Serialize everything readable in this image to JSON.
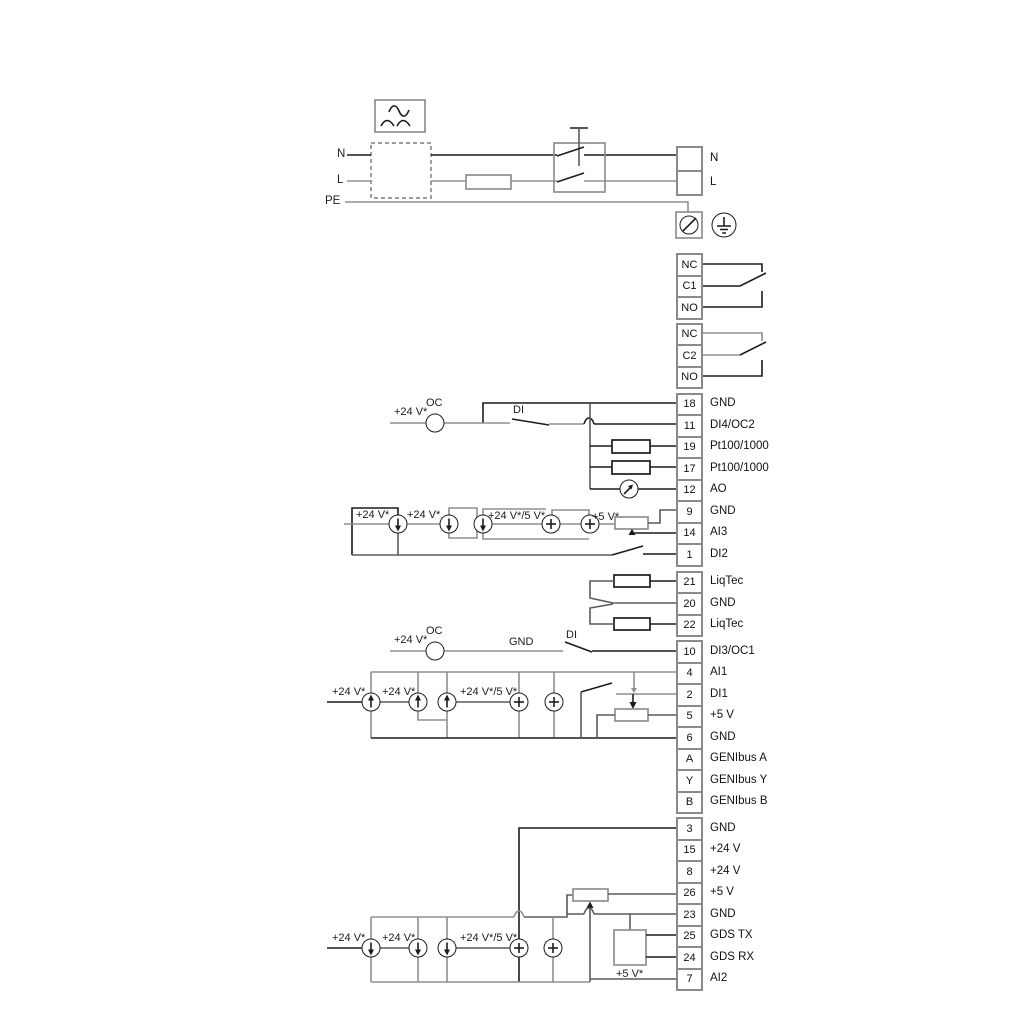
{
  "diagram_title": "pump wiring / terminal connection diagram",
  "colors": {
    "wire_dark": "#1c1c1c",
    "wire_gray": "#8f8f8f",
    "wire_mid": "#5a5a5a",
    "terminal_border": "#8a8a8a",
    "background": "#ffffff"
  },
  "power_labels_left": [
    {
      "text": "N",
      "x": 337,
      "y": 149
    },
    {
      "text": "L",
      "x": 337,
      "y": 175
    },
    {
      "text": "PE",
      "x": 325,
      "y": 196
    }
  ],
  "terminals": {
    "power": [
      {
        "num": "",
        "label": "N"
      },
      {
        "num": "",
        "label": "L"
      }
    ],
    "relay1": [
      {
        "num": "NC",
        "label": ""
      },
      {
        "num": "C1",
        "label": ""
      },
      {
        "num": "NO",
        "label": ""
      }
    ],
    "relay2": [
      {
        "num": "NC",
        "label": ""
      },
      {
        "num": "C2",
        "label": ""
      },
      {
        "num": "NO",
        "label": ""
      }
    ],
    "io1": [
      {
        "num": "18",
        "label": "GND"
      },
      {
        "num": "11",
        "label": "DI4/OC2"
      },
      {
        "num": "19",
        "label": "Pt100/1000"
      },
      {
        "num": "17",
        "label": "Pt100/1000"
      },
      {
        "num": "12",
        "label": "AO"
      },
      {
        "num": "9",
        "label": "GND"
      },
      {
        "num": "14",
        "label": "AI3"
      },
      {
        "num": "1",
        "label": "DI2"
      }
    ],
    "liqtec": [
      {
        "num": "21",
        "label": "LiqTec"
      },
      {
        "num": "20",
        "label": "GND"
      },
      {
        "num": "22",
        "label": "LiqTec"
      }
    ],
    "io2": [
      {
        "num": "10",
        "label": "DI3/OC1"
      },
      {
        "num": "4",
        "label": "AI1"
      },
      {
        "num": "2",
        "label": "DI1"
      },
      {
        "num": "5",
        "label": "+5 V"
      },
      {
        "num": "6",
        "label": "GND"
      },
      {
        "num": "A",
        "label": "GENIbus A"
      },
      {
        "num": "Y",
        "label": "GENIbus Y"
      },
      {
        "num": "B",
        "label": "GENIbus B"
      }
    ],
    "io3": [
      {
        "num": "3",
        "label": "GND"
      },
      {
        "num": "15",
        "label": "+24 V"
      },
      {
        "num": "8",
        "label": "+24 V"
      },
      {
        "num": "26",
        "label": "+5 V"
      },
      {
        "num": "23",
        "label": "GND"
      },
      {
        "num": "25",
        "label": "GDS TX"
      },
      {
        "num": "24",
        "label": "GDS RX"
      },
      {
        "num": "7",
        "label": "AI2"
      }
    ]
  },
  "annotations": [
    {
      "text": "+24 V*",
      "x": 394,
      "y": 407
    },
    {
      "text": "OC",
      "x": 426,
      "y": 398
    },
    {
      "text": "DI",
      "x": 513,
      "y": 405
    },
    {
      "text": "+24 V*",
      "x": 356,
      "y": 510
    },
    {
      "text": "+24 V*",
      "x": 407,
      "y": 510
    },
    {
      "text": "+24 V*/5 V*",
      "x": 488,
      "y": 511
    },
    {
      "text": "+5 V*",
      "x": 592,
      "y": 512
    },
    {
      "text": "+24 V*",
      "x": 394,
      "y": 635
    },
    {
      "text": "OC",
      "x": 426,
      "y": 626
    },
    {
      "text": "GND",
      "x": 509,
      "y": 637
    },
    {
      "text": "DI",
      "x": 566,
      "y": 630
    },
    {
      "text": "+24 V*",
      "x": 332,
      "y": 687
    },
    {
      "text": "+24 V*",
      "x": 382,
      "y": 687
    },
    {
      "text": "+24 V*/5 V*",
      "x": 460,
      "y": 687
    },
    {
      "text": "+24 V*",
      "x": 332,
      "y": 933
    },
    {
      "text": "+24 V*",
      "x": 382,
      "y": 933
    },
    {
      "text": "+24 V*/5 V*",
      "x": 460,
      "y": 933
    },
    {
      "text": "+5 V*",
      "x": 616,
      "y": 969
    }
  ]
}
